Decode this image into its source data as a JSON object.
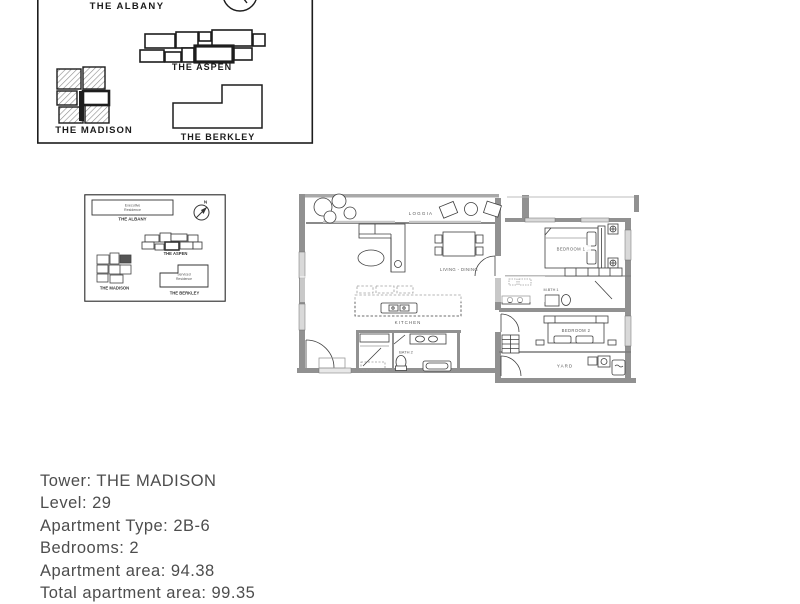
{
  "large_map": {
    "albany": "THE ALBANY",
    "aspen": "THE ASPEN",
    "madison": "THE MADISON",
    "berkley": "THE BERKLEY"
  },
  "small_map": {
    "albany": "THE ALBANY",
    "albany_type_line1": "Executive",
    "albany_type_line2": "Residence",
    "aspen": "THE ASPEN",
    "madison": "THE MADISON",
    "berkley": "THE BERKLEY",
    "berkley_type_line1": "Serviced",
    "berkley_type_line2": "Residence",
    "compass_n": "N"
  },
  "floor_plan": {
    "loggia": "LOGGIA",
    "living_dining": "LIVING - DINING",
    "bedroom1": "BEDROOM 1",
    "master_bath": "M.BTH 1",
    "kitchen": "KITCHEN",
    "bath2": "BATH 2",
    "bedroom2": "BEDROOM 2",
    "yard": "YARD"
  },
  "details": {
    "tower": "Tower: THE MADISON",
    "level": "Level: 29",
    "type": "Apartment Type: 2B-6",
    "bedrooms": "Bedrooms: 2",
    "area": "Apartment area: 94.38",
    "total_area": "Total apartment area: 99.35"
  },
  "colors": {
    "line": "#3f3f3f",
    "wall": "#919191",
    "text": "#4d4d4d"
  }
}
